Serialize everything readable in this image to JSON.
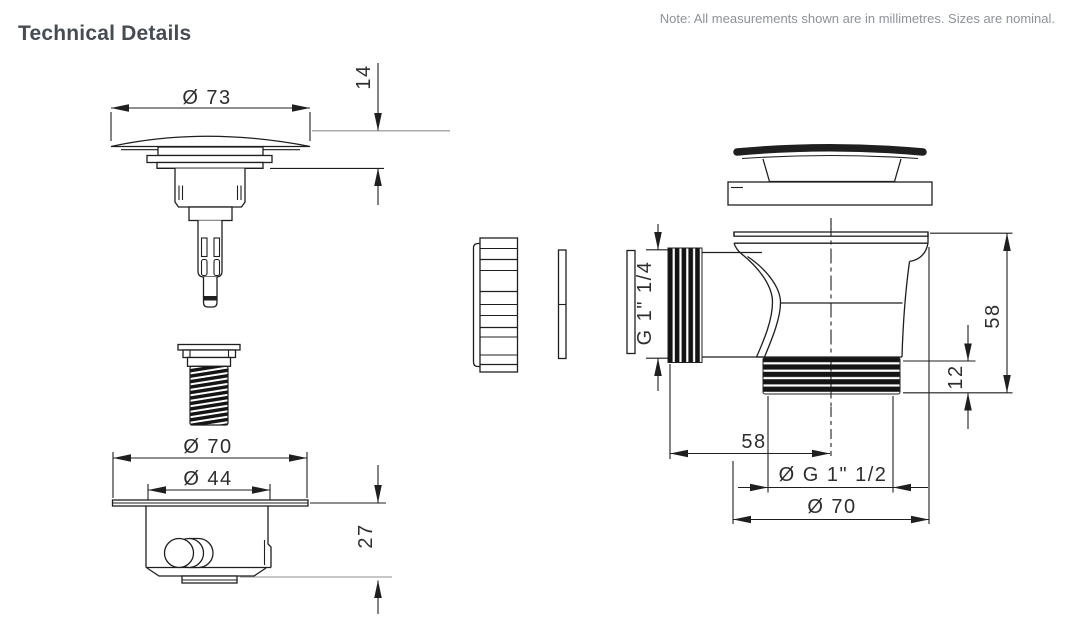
{
  "header": {
    "title": "Technical Details",
    "note": "Note: All measurements shown are in millimetres. Sizes are nominal."
  },
  "colors": {
    "line": "#1f1f1f",
    "dimension_text": "#2e2e2e",
    "title_text": "#474c54",
    "note_text": "#8d9299"
  },
  "drawings": {
    "plug": {
      "dim_diameter": "Ø 73",
      "dim_cap_height": "14"
    },
    "clicker_housing": {
      "dim_outer_diameter": "Ø 70",
      "dim_inner_diameter": "Ø 44",
      "dim_depth": "27"
    },
    "waste_body": {
      "dim_inlet_thread": "G 1\" 1/4",
      "dim_total_height": "58",
      "dim_outlet_thread_depth": "12",
      "dim_inlet_offset": "58",
      "dim_outlet_thread": "Ø G 1\" 1/2",
      "dim_flange_diameter": "Ø 70"
    }
  }
}
